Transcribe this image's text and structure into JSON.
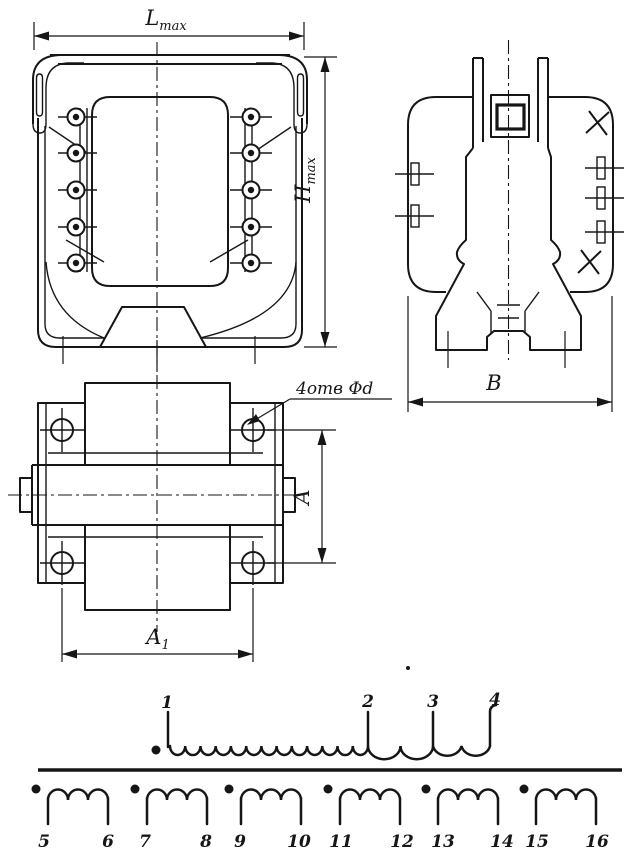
{
  "drawing": {
    "colors": {
      "ink": "#161616",
      "paper": "#ffffff"
    },
    "dimensions": {
      "l_max": {
        "base": "L",
        "sub": "max"
      },
      "h_max": {
        "base": "H",
        "sub": "max"
      },
      "b": "В",
      "a": "A",
      "a1": {
        "base": "A",
        "sub": "1"
      },
      "holes_note": "4отв Φd"
    },
    "schematic": {
      "primary_terminals": [
        "1",
        "2",
        "3",
        "4"
      ],
      "secondary_terminals": [
        "5",
        "6",
        "7",
        "8",
        "9",
        "10",
        "11",
        "12",
        "13",
        "14",
        "15",
        "16"
      ]
    }
  }
}
